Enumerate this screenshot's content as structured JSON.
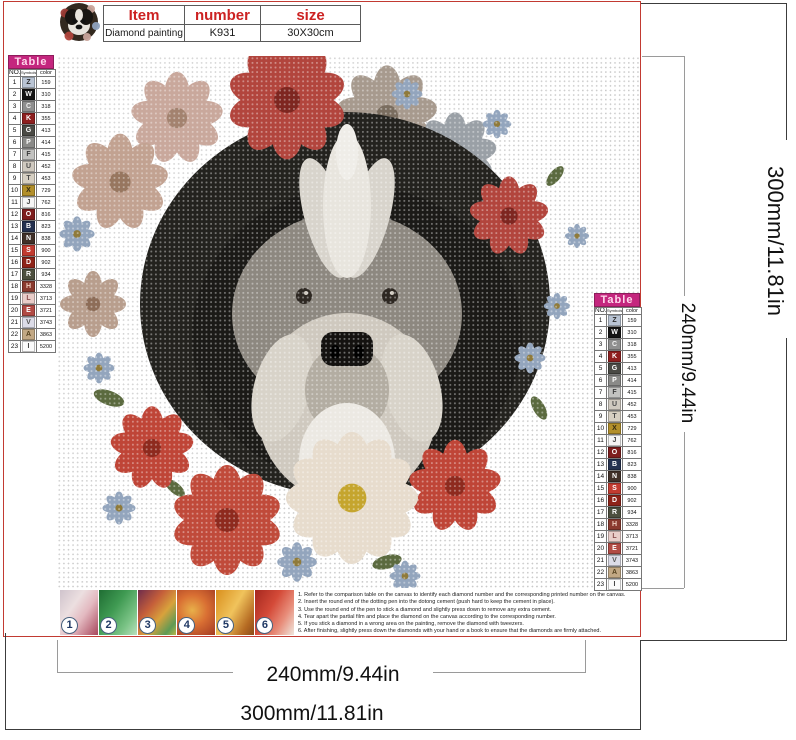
{
  "product": {
    "logo": "shih-tzu-flower-wreath-logo",
    "header": {
      "columns": [
        "Item",
        "number",
        "size"
      ],
      "item": "Diamond painting",
      "number": "K931",
      "size": "30X30cm"
    }
  },
  "color_table": {
    "title": "Table",
    "columns": [
      "NO.",
      "Symbols",
      "color"
    ],
    "rows": [
      {
        "no": "1",
        "symbol": "Z",
        "code": "159",
        "bg": "#b9c4d4",
        "fg": "#2a2a2a"
      },
      {
        "no": "2",
        "symbol": "W",
        "code": "310",
        "bg": "#141414",
        "fg": "#ffffff"
      },
      {
        "no": "3",
        "symbol": "C",
        "code": "318",
        "bg": "#8f8f8f",
        "fg": "#f0f0f0"
      },
      {
        "no": "4",
        "symbol": "K",
        "code": "355",
        "bg": "#8e1f1f",
        "fg": "#ffffff"
      },
      {
        "no": "5",
        "symbol": "G",
        "code": "413",
        "bg": "#4a4a45",
        "fg": "#ffffff"
      },
      {
        "no": "6",
        "symbol": "P",
        "code": "414",
        "bg": "#8a8a88",
        "fg": "#ffffff"
      },
      {
        "no": "7",
        "symbol": "F",
        "code": "415",
        "bg": "#c2c2c0",
        "fg": "#3a3a3a"
      },
      {
        "no": "8",
        "symbol": "U",
        "code": "452",
        "bg": "#cfc9bf",
        "fg": "#4a4a4a"
      },
      {
        "no": "9",
        "symbol": "T",
        "code": "453",
        "bg": "#d6cfc2",
        "fg": "#4a4a4a"
      },
      {
        "no": "10",
        "symbol": "X",
        "code": "729",
        "bg": "#b28f2a",
        "fg": "#332a10"
      },
      {
        "no": "11",
        "symbol": "J",
        "code": "762",
        "bg": "#f5f5f5",
        "fg": "#444444"
      },
      {
        "no": "12",
        "symbol": "O",
        "code": "816",
        "bg": "#7e1d1d",
        "fg": "#ffffff"
      },
      {
        "no": "13",
        "symbol": "B",
        "code": "823",
        "bg": "#23304f",
        "fg": "#ffffff"
      },
      {
        "no": "14",
        "symbol": "N",
        "code": "838",
        "bg": "#403028",
        "fg": "#ffffff"
      },
      {
        "no": "15",
        "symbol": "S",
        "code": "900",
        "bg": "#c23b30",
        "fg": "#ffffff"
      },
      {
        "no": "16",
        "symbol": "D",
        "code": "902",
        "bg": "#8e2318",
        "fg": "#ffffff"
      },
      {
        "no": "17",
        "symbol": "R",
        "code": "934",
        "bg": "#4c4f3e",
        "fg": "#ffffff"
      },
      {
        "no": "18",
        "symbol": "H",
        "code": "3328",
        "bg": "#8a3a2e",
        "fg": "#f0d0c0"
      },
      {
        "no": "19",
        "symbol": "L",
        "code": "3713",
        "bg": "#e9cdc9",
        "fg": "#8a5050"
      },
      {
        "no": "20",
        "symbol": "E",
        "code": "3721",
        "bg": "#b14a44",
        "fg": "#ffffff"
      },
      {
        "no": "21",
        "symbol": "V",
        "code": "3743",
        "bg": "#dcdce8",
        "fg": "#555555"
      },
      {
        "no": "22",
        "symbol": "A",
        "code": "3863",
        "bg": "#c2a884",
        "fg": "#55421f"
      },
      {
        "no": "23",
        "symbol": "I",
        "code": "5200",
        "bg": "#fbfbfb",
        "fg": "#444444"
      }
    ]
  },
  "dimensions": {
    "right_outer": "300mm/11.81in",
    "right_inner": "240mm/9.44in",
    "bottom_inner": "240mm/9.44in",
    "bottom_outer": "300mm/11.81in"
  },
  "instructions": {
    "steps": [
      "1. Refer to the comparison table on the canvas to identify each diamond number and the corresponding printed number on the canvas.",
      "2. Insert the round end of the dotting pen into the dotong cement (push hard to keep the cement in place).",
      "3. Use the round end of the pen to stick a diamond and slightly press down to remove any extra cement.",
      "4. Tear apart the partial film and place the diamond on the canvas according to the corresponding number.",
      "5. If you stick a diamond in a wrong area on the painting, remove the diamond with tweezers.",
      "6. After finishing, slightly press down the diamonds with your hand or a book to ensure that the diamonds are firmly attached."
    ],
    "thumbnails": [
      "1",
      "2",
      "3",
      "4",
      "5",
      "6"
    ]
  },
  "colors": {
    "frame_red": "#c23a32",
    "table_title_bg": "#c4267e",
    "header_text_red": "#cc2222",
    "dimension_line_dark": "#3c3c3c",
    "dimension_line_light": "#9a9a9a"
  }
}
